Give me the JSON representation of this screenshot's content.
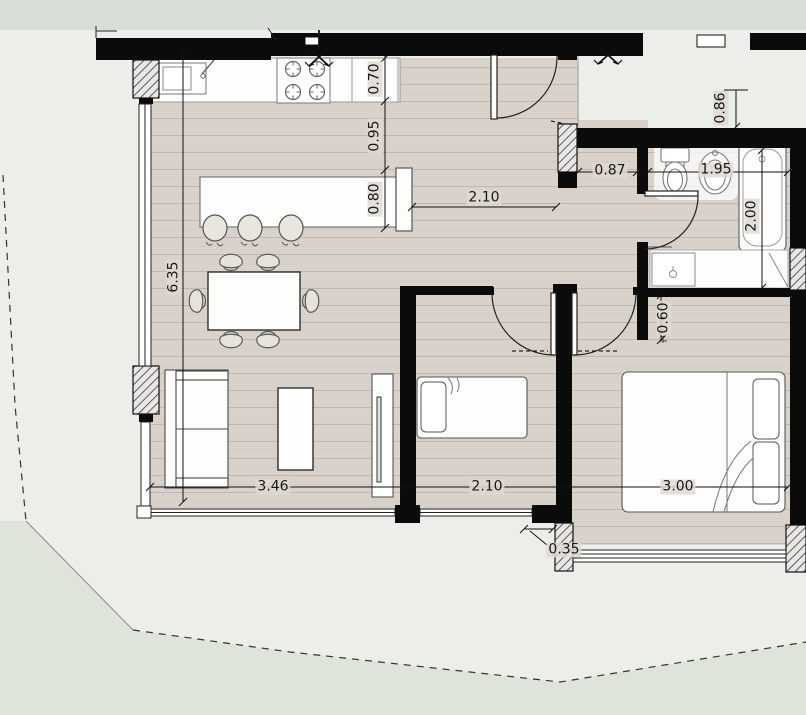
{
  "floor_plan": {
    "dimension_labels": {
      "counter_depth": "0.70",
      "kitchen_aisle": "0.95",
      "island_depth": "0.80",
      "kitchen_width": "2.10",
      "living_zone_length": "6.35",
      "living_width": "3.46",
      "small_bedroom_width": "2.10",
      "main_bedroom_width": "3.00",
      "facade_step": "0.35",
      "hallway_width": "0.87",
      "bathroom_width": "1.95",
      "bathroom_length": "2.00",
      "entry_recess": "0.86",
      "wardrobe_depth": "0.60"
    },
    "colors": {
      "wall": "#0b0b0b",
      "floor": "#d9d2ca",
      "floor_line": "#c0b8ae",
      "paper": "#ecefe9",
      "terrain_top": "#d8ded5",
      "terrain_bottom": "#dee4da"
    }
  }
}
